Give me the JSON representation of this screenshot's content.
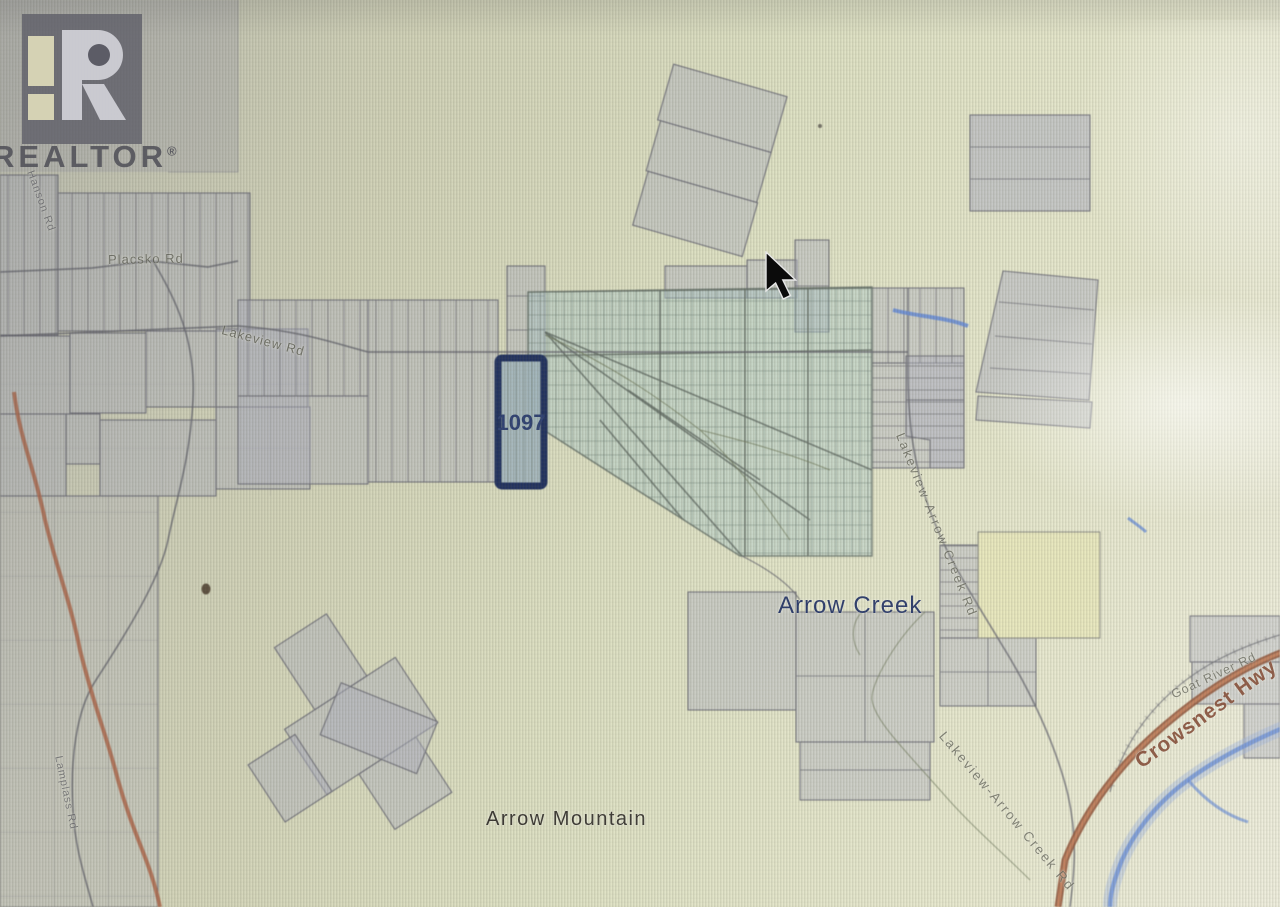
{
  "branding": {
    "realtor_text": "REALTOR",
    "reg_mark": "®"
  },
  "map": {
    "parcel_label": "1097",
    "places": {
      "arrow_creek": "Arrow Creek",
      "arrow_mountain": "Arrow Mountain"
    },
    "roads": {
      "crowsnest": "Crowsnest Hwy",
      "goat_river": "Goat River Rd",
      "placsko": "Placsko Rd",
      "lakeview": "Lakeview Rd",
      "lakeview_arrow_a": "Lakeview-Arrow Creek Rd",
      "lakeview_arrow_b": "Lakeview-Arrow Creek Rd",
      "hanson": "Hanson Rd",
      "lamplass": "Lamplass Rd"
    },
    "colors": {
      "background": "#dcdec1",
      "parcel_fill": "#b0b2c0",
      "parcel_outline": "#6f6f78",
      "subdivision_fill": "#aac8c6",
      "selected_outline": "#182a5c",
      "selected_fill": "#9fb4bd",
      "highway_orange": "#a8552f",
      "river_blue": "#5b84d8",
      "place_label_navy": "#1e2f63",
      "mountain_label_dark": "#33302a"
    }
  }
}
